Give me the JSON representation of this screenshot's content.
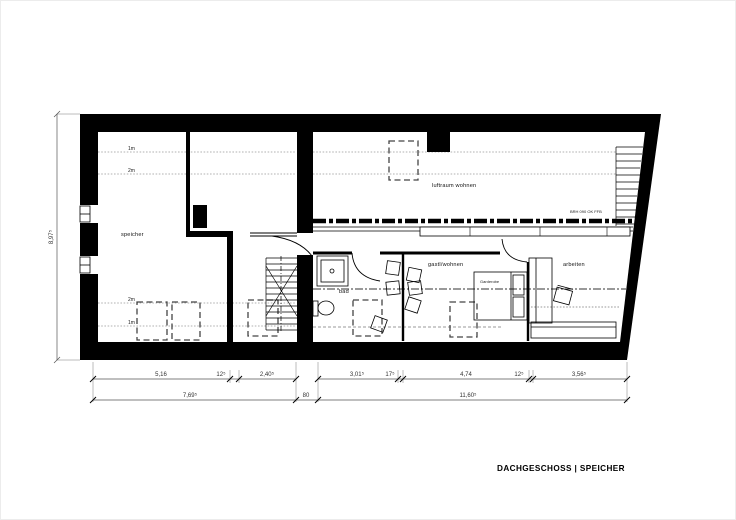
{
  "drawing_title": "DACHGESCHOSS | SPEICHER",
  "rooms": {
    "speicher": "speicher",
    "luftraum": "luftraum wohnen",
    "bad": "bad",
    "gast": "gastl/wohnen",
    "arbeiten": "arbeiten"
  },
  "annotations": {
    "wardrobe": "Garderobe",
    "railing_note": "BRH 090 OK FFB"
  },
  "height_lines": {
    "top_1m": "1m",
    "top_2m": "2m",
    "bottom_2m": "2m",
    "bottom_1m": "1m"
  },
  "dimensions": {
    "vertical_total": "8,97⁵",
    "row1": [
      "5,16",
      "12⁵",
      "2,40⁵",
      "3,01⁵",
      "17⁵",
      "4,74",
      "12⁵",
      "3,56⁵"
    ],
    "row2": [
      "7,69⁵",
      "80",
      "11,60⁵"
    ]
  },
  "colors": {
    "ink": "#000000",
    "dim": "#404040"
  }
}
